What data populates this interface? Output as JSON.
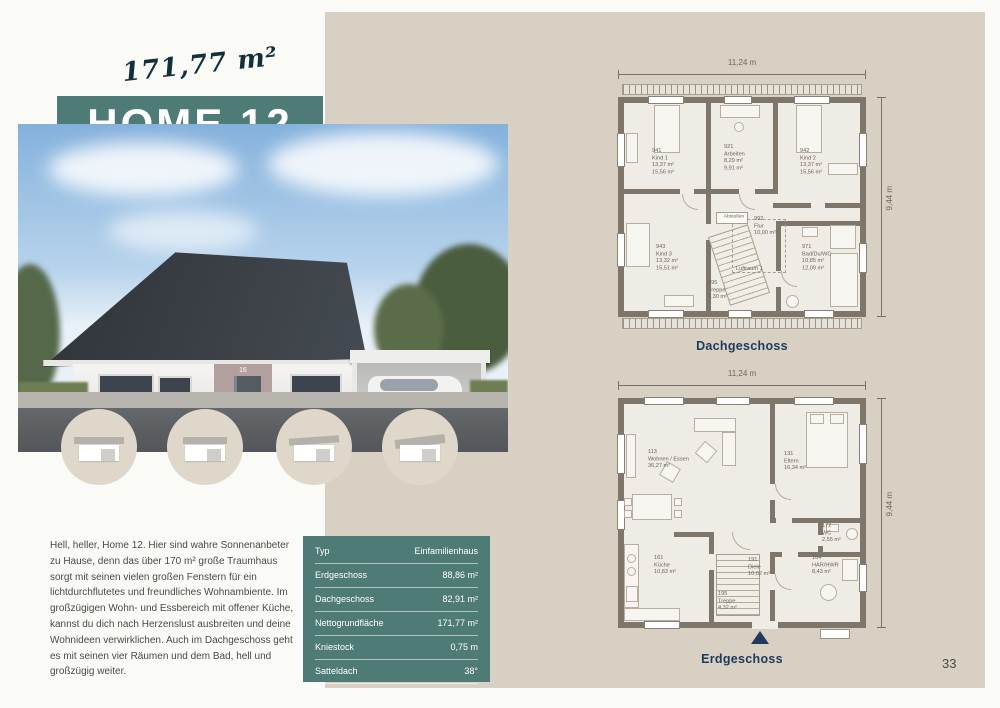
{
  "page_number": "33",
  "hero": {
    "area_script": "171,77 m²",
    "title": "HOME 12",
    "house_number": "16",
    "photo_credit": "allkauf haus"
  },
  "description": "Hell, heller, Home 12. Hier sind wahre Sonnenanbeter zu Hause, denn das über 170 m² große Traumhaus sorgt mit seinen vielen großen Fenstern für ein lichtdurchflutetes und freundliches Wohnambiente. Im großzügigen Wohn- und Essbereich mit offener Küche, kannst du dich nach Herzenslust ausbreiten und deine Wohnideen verwirklichen. Auch im Dachgeschoss geht es mit seinen vier Räumen und dem Bad, hell und großzügig weiter.",
  "specs": {
    "rows": [
      {
        "label": "Typ",
        "value": "Einfamilienhaus"
      },
      {
        "label": "Erdgeschoss",
        "value": "88,86 m²"
      },
      {
        "label": "Dachgeschoss",
        "value": "82,91 m²"
      },
      {
        "label": "Nettogrundfläche",
        "value": "171,77 m²"
      },
      {
        "label": "Kniestock",
        "value": "0,75 m"
      },
      {
        "label": "Satteldach",
        "value": "38°"
      }
    ]
  },
  "plans": {
    "dg": {
      "caption": "Dachgeschoss",
      "dim_w": "11,24 m",
      "dim_h": "9,44 m",
      "rooms": {
        "kind1": {
          "l1": "941",
          "l2": "Kind 1",
          "l3": "13,37 m²",
          "l4": "15,56 m²"
        },
        "arbeiten": {
          "l1": "921",
          "l2": "Arbeiten",
          "l3": "8,29 m²",
          "l4": "9,91 m²"
        },
        "kind2": {
          "l1": "942",
          "l2": "Kind 2",
          "l3": "13,37 m²",
          "l4": "15,56 m²"
        },
        "kind3": {
          "l1": "943",
          "l2": "Kind 3",
          "l3": "13,32 m²",
          "l4": "15,51 m²"
        },
        "flur": {
          "l1": "992",
          "l2": "Flur",
          "l3": "10,00 m²"
        },
        "bad": {
          "l1": "971",
          "l2": "Bad/Du/WC",
          "l3": "10,85 m²",
          "l4": "12,09 m²"
        },
        "treppe": {
          "l1": "995",
          "l2": "Treppe",
          "l3": "4,30 m²"
        },
        "luftraum": {
          "l1": "Luftraum 1"
        },
        "abstellen": {
          "l1": "Abstellen"
        }
      }
    },
    "eg": {
      "caption": "Erdgeschoss",
      "dim_w": "11,24 m",
      "dim_h": "9,44 m",
      "rooms": {
        "wohnen": {
          "l1": "113",
          "l2": "Wohnen / Essen",
          "l3": "36,27 m²"
        },
        "eltern": {
          "l1": "131",
          "l2": "Eltern",
          "l3": "16,34 m²"
        },
        "kueche": {
          "l1": "161",
          "l2": "Küche",
          "l3": "10,83 m²"
        },
        "diele": {
          "l1": "191",
          "l2": "Diele",
          "l3": "10,02 m²"
        },
        "treppe": {
          "l1": "195",
          "l2": "Treppe",
          "l3": "4,32 m²"
        },
        "wc": {
          "l1": "172",
          "l2": "WC",
          "l3": "2,55 m²"
        },
        "hwr": {
          "l1": "164",
          "l2": "HAR/HWR",
          "l3": "8,43 m²"
        }
      }
    }
  }
}
